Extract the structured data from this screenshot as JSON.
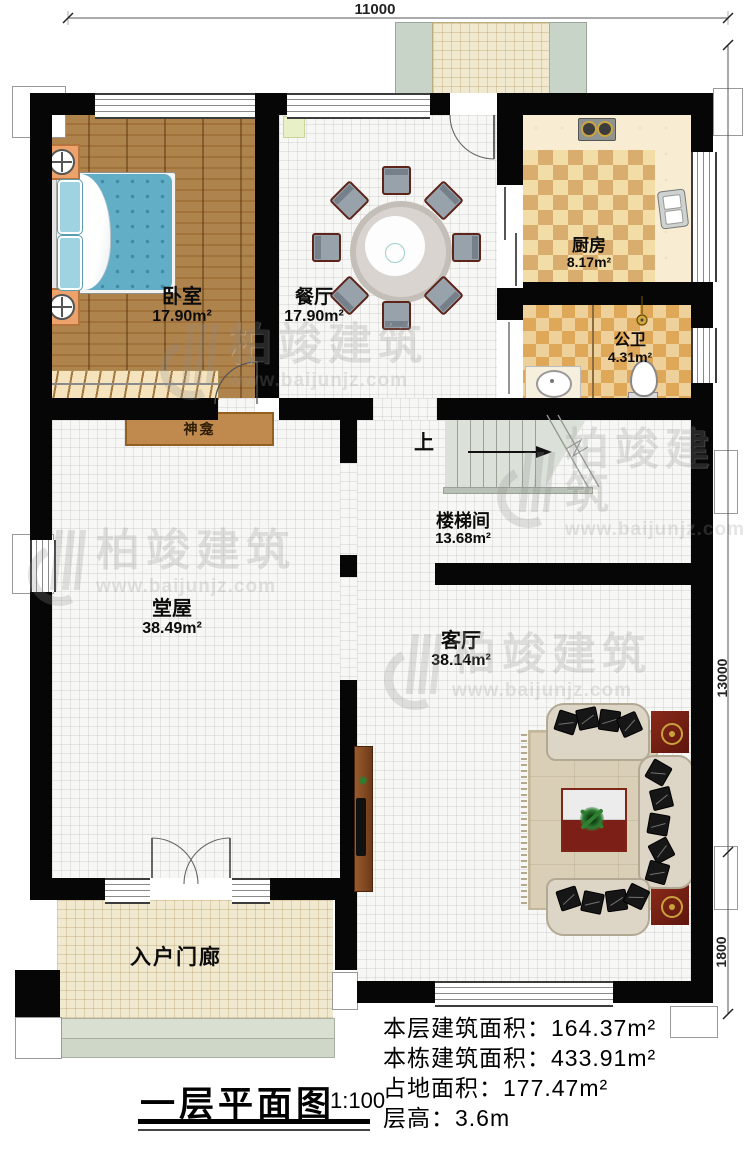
{
  "meta": {
    "title": "一层平面图",
    "scale": "1:100"
  },
  "dimensions": {
    "top_width": "11000",
    "right_height_main": "13000",
    "right_height_porch": "1800"
  },
  "rooms": {
    "bedroom": {
      "name": "卧室",
      "area": "17.90m²"
    },
    "dining": {
      "name": "餐厅",
      "area": "17.90m²"
    },
    "kitchen": {
      "name": "厨房",
      "area": "8.17m²"
    },
    "bathroom": {
      "name": "公卫",
      "area": "4.31m²"
    },
    "stairwell": {
      "name": "楼梯间",
      "area": "13.68m²"
    },
    "hall": {
      "name": "堂屋",
      "area": "38.49m²"
    },
    "living_room": {
      "name": "客厅",
      "area": "38.14m²"
    },
    "entry_porch": {
      "name": "入户门廊"
    }
  },
  "annotations": {
    "shrine": "神龛",
    "stairs_up": "上"
  },
  "stats": {
    "lines": [
      "本层建筑面积：164.37m²",
      "本栋建筑面积：433.91m²",
      "占地面积：177.47m²",
      "层高：3.6m"
    ]
  },
  "watermark": {
    "name": "柏竣建筑",
    "url": "www.baijunjz.com"
  },
  "colors": {
    "wall": "#060606",
    "wood_floor": "#a97a3f",
    "kitchen_tile": "#d9ad6e",
    "bath_tile": "#dfa858",
    "porch_floor": "#f1e9cf",
    "stair": "#dbe1d9",
    "shrine": "#c08a4e",
    "watermark_gray": "#8f8f8f",
    "sofa": "#ddd6c6",
    "accent_red": "#7c2017"
  }
}
